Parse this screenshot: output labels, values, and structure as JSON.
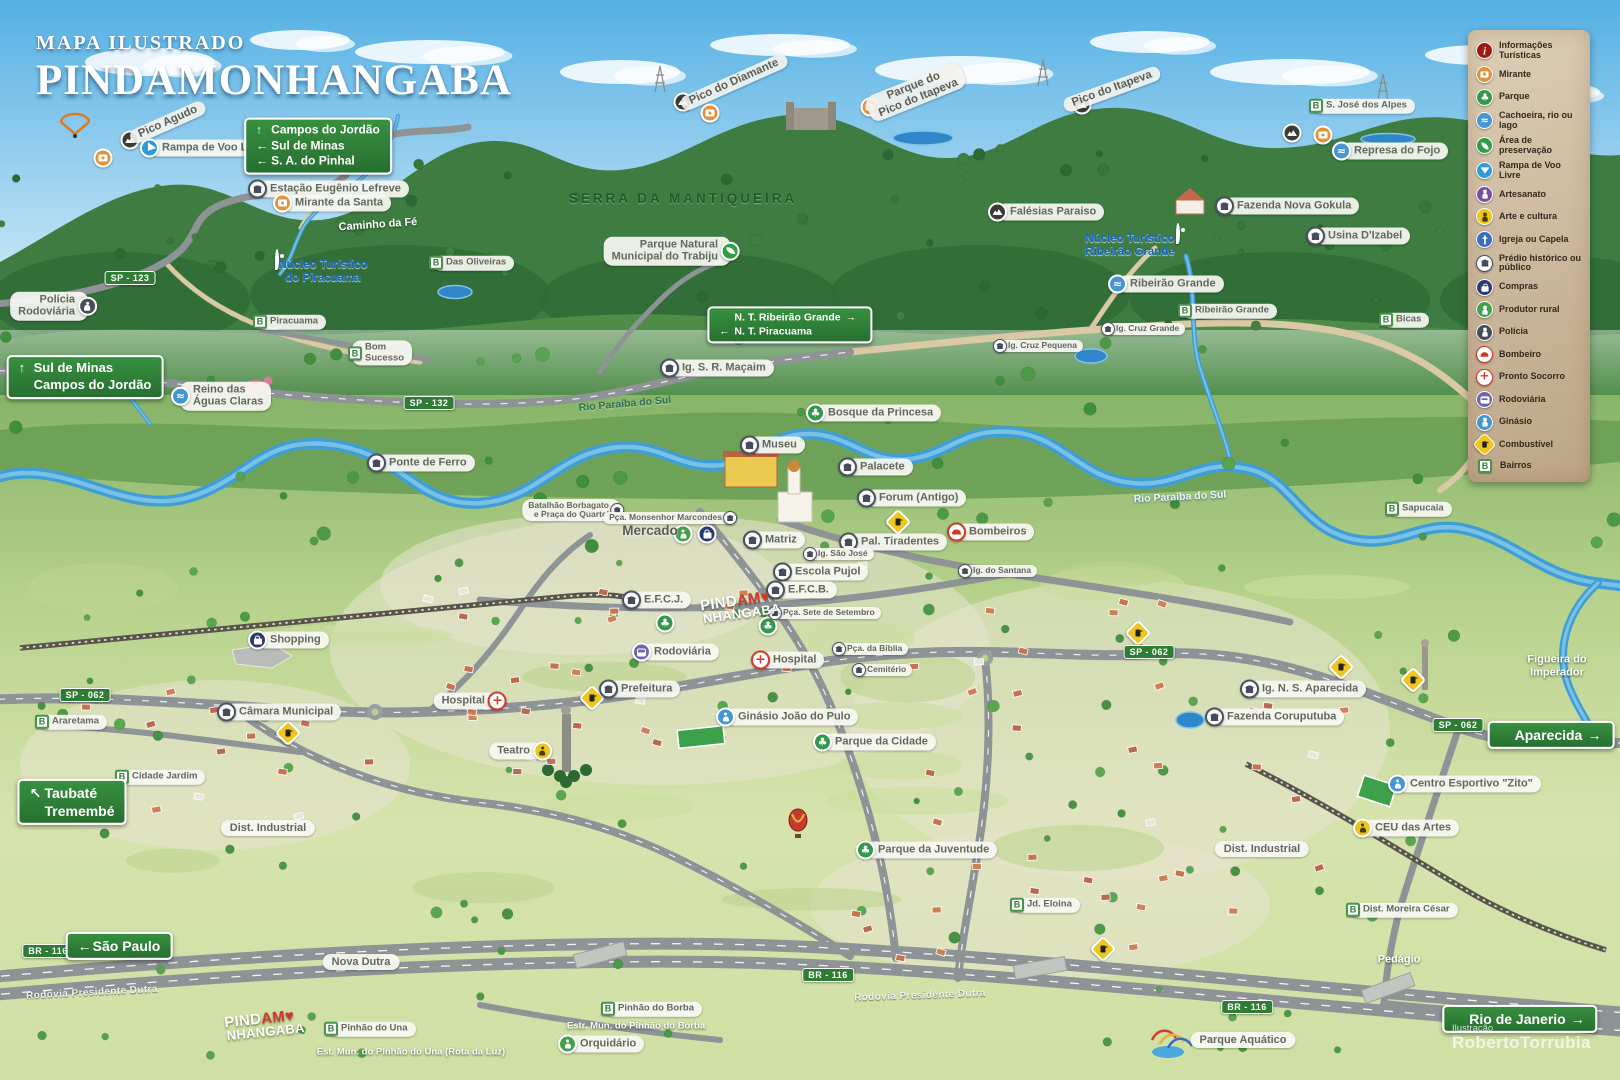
{
  "title": {
    "kicker": "MAPA ILUSTRADO",
    "name": "PINDAMONHANGABA"
  },
  "credit": {
    "label": "Ilustração",
    "name": "RobertoTorrubia"
  },
  "colors": {
    "sign_green": "#2f7d35",
    "pill_bg": "#f7f7f2",
    "water": "#3f9ed6",
    "legend_bg": "#cab69b",
    "logo_red": "#d5352c",
    "pin_blue": "#1565c0"
  },
  "legend": {
    "items": [
      {
        "type": "info",
        "label": "Informações Turísticas"
      },
      {
        "type": "mirante",
        "label": "Mirante"
      },
      {
        "type": "parque",
        "label": "Parque"
      },
      {
        "type": "cachoeira",
        "label": "Cachoeira, rio ou lago"
      },
      {
        "type": "preservacao",
        "label": "Área de preservação"
      },
      {
        "type": "rampa",
        "label": "Rampa de Voo Livre"
      },
      {
        "type": "artesanato",
        "label": "Artesanato"
      },
      {
        "type": "arte",
        "label": "Arte e cultura"
      },
      {
        "type": "igreja",
        "label": "Igreja ou Capela"
      },
      {
        "type": "predio",
        "label": "Prédio histórico ou público"
      },
      {
        "type": "compras",
        "label": "Compras"
      },
      {
        "type": "produtor",
        "label": "Produtor rural"
      },
      {
        "type": "policia",
        "label": "Polícia"
      },
      {
        "type": "bombeiro",
        "label": "Bombeiro"
      },
      {
        "type": "pronto",
        "label": "Pronto Socorro"
      },
      {
        "type": "rodoviaria",
        "label": "Rodoviária"
      },
      {
        "type": "ginasio",
        "label": "Ginásio"
      },
      {
        "type": "combustivel",
        "label": "Combustível"
      },
      {
        "type": "bairro",
        "label": "Bairros"
      }
    ]
  },
  "signs": [
    {
      "name": "sign-campos-do-jordao",
      "x": 318,
      "y": 146,
      "fs": 12,
      "rows": [
        [
          "↑",
          "Campos do Jordão",
          ""
        ],
        [
          "←",
          "Sul de Minas",
          ""
        ],
        [
          "←",
          "S. A. do Pinhal",
          ""
        ]
      ]
    },
    {
      "name": "sign-sul-de-minas",
      "x": 85,
      "y": 377,
      "fs": 13,
      "rows": [
        [
          "↑",
          "Sul de Minas",
          ""
        ],
        [
          "",
          "Campos do Jordão",
          ""
        ]
      ]
    },
    {
      "name": "sign-nucleos-turisticos",
      "x": 790,
      "y": 325,
      "fs": 10.5,
      "rows": [
        [
          "",
          "N. T. Ribeirão Grande",
          "→"
        ],
        [
          "←",
          "N. T. Piracuama",
          ""
        ]
      ]
    },
    {
      "name": "sign-taubate",
      "x": 72,
      "y": 802,
      "fs": 14,
      "rows": [
        [
          "↖",
          "Taubaté",
          ""
        ],
        [
          "",
          "Tremembé",
          ""
        ]
      ]
    },
    {
      "name": "sign-sao-paulo",
      "x": 119,
      "y": 946,
      "fs": 14,
      "rows": [
        [
          "←",
          "São Paulo",
          ""
        ]
      ]
    },
    {
      "name": "sign-aparecida",
      "x": 1551,
      "y": 735,
      "fs": 14,
      "rows": [
        [
          "",
          "Aparecida",
          "→"
        ]
      ]
    },
    {
      "name": "sign-rio-de-janeiro",
      "x": 1520,
      "y": 1019,
      "fs": 14,
      "rows": [
        [
          "",
          "Rio de Janerio",
          "→"
        ]
      ]
    }
  ],
  "road_badges": [
    {
      "text": "SP - 123",
      "x": 130,
      "y": 278
    },
    {
      "text": "SP - 132",
      "x": 429,
      "y": 403
    },
    {
      "text": "SP - 062",
      "x": 85,
      "y": 695
    },
    {
      "text": "SP - 062",
      "x": 1149,
      "y": 652
    },
    {
      "text": "SP - 062",
      "x": 1458,
      "y": 725
    },
    {
      "text": "BR - 116",
      "x": 48,
      "y": 951
    },
    {
      "text": "BR - 116",
      "x": 828,
      "y": 975
    },
    {
      "text": "BR - 116",
      "x": 1247,
      "y": 1007
    }
  ],
  "peaks": [
    {
      "text": "Pico Agudo",
      "x": 168,
      "y": 122,
      "rot": -24
    },
    {
      "text": "Pico do Diamante",
      "x": 734,
      "y": 82,
      "rot": -24
    },
    {
      "lines": [
        "Parque do",
        "Pico do Itapeva"
      ],
      "x": 916,
      "y": 92,
      "rot": -22
    },
    {
      "text": "Pico do Itapeva",
      "x": 1112,
      "y": 89,
      "rot": -20
    }
  ],
  "pois": [
    {
      "icon": "predio",
      "text": "Estação Eugênio Lefreve",
      "x": 258,
      "y": 189
    },
    {
      "icon": "mirante",
      "text": "Mirante da Santa",
      "x": 283,
      "y": 203
    },
    {
      "icon": "rampa",
      "text": "Rampa de Voo Livre",
      "x": 150,
      "y": 148
    },
    {
      "icon": "cachoeira",
      "lines": [
        "Reino das",
        "Águas Claras"
      ],
      "x": 181,
      "y": 396
    },
    {
      "icon": "policia",
      "lines": [
        "Polícia",
        "Rodoviária"
      ],
      "x": 87,
      "y": 306,
      "side": "r"
    },
    {
      "icon": "predio",
      "text": "Ponte de Ferro",
      "x": 377,
      "y": 463
    },
    {
      "icon": "preservacao",
      "lines": [
        "Parque Natural",
        "Municipal  do Trabiju"
      ],
      "x": 730,
      "y": 251,
      "side": "r"
    },
    {
      "icon": "predio",
      "text": "Ig. S. R. Maçaim",
      "x": 670,
      "y": 368
    },
    {
      "icon": "mirante-dark",
      "text": "Falésias Paraiso",
      "x": 998,
      "y": 212
    },
    {
      "icon": "cachoeira",
      "text": "Represa do Fojo",
      "x": 1342,
      "y": 151
    },
    {
      "icon": "predio",
      "text": "Fazenda Nova Gokula",
      "x": 1225,
      "y": 206
    },
    {
      "icon": "predio",
      "text": "Usina D'Izabel",
      "x": 1316,
      "y": 236
    },
    {
      "icon": "cachoeira",
      "text": "Ribeirão Grande",
      "x": 1118,
      "y": 284
    },
    {
      "icon": "predio",
      "text": "Ig. Cruz Grande",
      "x": 1111,
      "y": 329,
      "small": true
    },
    {
      "icon": "predio",
      "text": "Ig. Cruz Pequena",
      "x": 1003,
      "y": 346,
      "small": true
    },
    {
      "icon": "parque",
      "text": "Bosque da Princesa",
      "x": 816,
      "y": 413
    },
    {
      "icon": "predio",
      "text": "Museu",
      "x": 750,
      "y": 445
    },
    {
      "icon": "predio",
      "text": "Palacete",
      "x": 848,
      "y": 467
    },
    {
      "icon": "predio",
      "text": "Forum (Antigo)",
      "x": 867,
      "y": 498
    },
    {
      "icon": "predio",
      "lines": [
        "Batalhão Borbagato",
        "e Praça do Quartel"
      ],
      "x": 614,
      "y": 510,
      "side": "r",
      "small": true
    },
    {
      "icon": "predio",
      "text": "Pça. Monsenhor Marcondes",
      "x": 727,
      "y": 518,
      "side": "r",
      "small": true
    },
    {
      "icon": "predio",
      "text": "Matriz",
      "x": 753,
      "y": 540
    },
    {
      "icon": "predio",
      "text": "Pal. Tiradentes",
      "x": 849,
      "y": 542
    },
    {
      "icon": "predio",
      "text": "Ig. São José",
      "x": 813,
      "y": 554,
      "small": true
    },
    {
      "icon": "bombeiro",
      "text": "Bombeiros",
      "x": 957,
      "y": 532
    },
    {
      "icon": "predio",
      "text": "Ig. do Santana",
      "x": 968,
      "y": 571,
      "small": true
    },
    {
      "icon": "predio",
      "text": "Escola Pujol",
      "x": 783,
      "y": 572
    },
    {
      "icon": "predio",
      "text": "E.F.C.B.",
      "x": 776,
      "y": 590
    },
    {
      "icon": "predio",
      "text": "E.F.C.J.",
      "x": 632,
      "y": 600
    },
    {
      "icon": "predio",
      "text": "Pça. Sete de Setembro",
      "x": 778,
      "y": 613,
      "small": true
    },
    {
      "icon": "rodoviaria",
      "text": "Rodoviária",
      "x": 642,
      "y": 652
    },
    {
      "icon": "pronto",
      "text": "Hospital",
      "x": 761,
      "y": 660
    },
    {
      "icon": "predio",
      "text": "Pça. da Bíblia",
      "x": 842,
      "y": 649,
      "small": true
    },
    {
      "icon": "predio",
      "text": "Cemitério",
      "x": 862,
      "y": 670,
      "small": true
    },
    {
      "icon": "predio",
      "text": "Prefeitura",
      "x": 609,
      "y": 689
    },
    {
      "icon": "pronto",
      "text": "Hospital",
      "x": 497,
      "y": 701,
      "side": "r"
    },
    {
      "icon": "ginasio",
      "text": "Ginásio João do Pulo",
      "x": 726,
      "y": 717
    },
    {
      "icon": "arte",
      "text": "Teatro",
      "x": 542,
      "y": 751,
      "side": "r"
    },
    {
      "icon": "compras",
      "text": "Shopping",
      "x": 258,
      "y": 640
    },
    {
      "icon": "predio",
      "text": "Câmara Municipal",
      "x": 227,
      "y": 712
    },
    {
      "icon": "parque",
      "text": "Parque da Cidade",
      "x": 823,
      "y": 742
    },
    {
      "icon": "parque",
      "text": "Parque da Juventude",
      "x": 866,
      "y": 850
    },
    {
      "icon": "predio",
      "text": "Ig. N. S. Aparecida",
      "x": 1250,
      "y": 689
    },
    {
      "icon": "predio",
      "text": "Fazenda Coruputuba",
      "x": 1215,
      "y": 717
    },
    {
      "icon": "ginasio",
      "text": "Centro Esportivo \"Zito\"",
      "x": 1398,
      "y": 784
    },
    {
      "icon": "arte",
      "text": "CEU das Artes",
      "x": 1363,
      "y": 828
    },
    {
      "icon": "produtor",
      "text": "Orquidário",
      "x": 568,
      "y": 1044
    }
  ],
  "bairros": [
    {
      "text": "S. José dos Alpes",
      "x": 1317,
      "y": 106
    },
    {
      "text": "Das Oliveiras",
      "x": 437,
      "y": 263
    },
    {
      "text": "Piracuama",
      "x": 261,
      "y": 322
    },
    {
      "lines": [
        "Bom",
        "Sucesso"
      ],
      "x": 356,
      "y": 353
    },
    {
      "text": "Ribeirão Grande",
      "x": 1186,
      "y": 311
    },
    {
      "text": "Bicas",
      "x": 1387,
      "y": 320
    },
    {
      "text": "Sapucaia",
      "x": 1393,
      "y": 509
    },
    {
      "text": "Araretama",
      "x": 43,
      "y": 722
    },
    {
      "text": "Cidade Jardim",
      "x": 123,
      "y": 777
    },
    {
      "text": "Jd. Eloina",
      "x": 1018,
      "y": 905
    },
    {
      "text": "Dist. Moreira César",
      "x": 1354,
      "y": 910
    },
    {
      "text": "Pinhão do Una",
      "x": 332,
      "y": 1029
    },
    {
      "text": "Pinhão do Borba",
      "x": 609,
      "y": 1009
    }
  ],
  "plain_pills": [
    {
      "text": "Nova Dutra",
      "x": 361,
      "y": 962
    },
    {
      "text": "Dist. Industrial",
      "x": 268,
      "y": 828
    },
    {
      "text": "Dist. Industrial",
      "x": 1262,
      "y": 849
    },
    {
      "text": "Parque Aquático",
      "x": 1243,
      "y": 1040
    }
  ],
  "blue_pois": [
    {
      "lines": [
        "Núcleo Turístico",
        "do Piracuama"
      ],
      "x": 323,
      "y": 272
    },
    {
      "lines": [
        "Núcleo Turístico",
        "Ribeirão Grande"
      ],
      "x": 1130,
      "y": 246
    }
  ],
  "texts": [
    {
      "text": "SERRA DA MANTIQUEIRA",
      "x": 683,
      "y": 199,
      "cls": "tserra"
    },
    {
      "text": "Caminho da Fé",
      "x": 378,
      "y": 225,
      "cls": "tw",
      "rot": -4
    },
    {
      "text": "Mercado",
      "x": 650,
      "y": 531,
      "cls": "tmerc"
    },
    {
      "text": "Rio Paraíba do Sul",
      "x": 625,
      "y": 404,
      "cls": "trivd",
      "rot": -5
    },
    {
      "text": "Rio Paraíba do Sul",
      "x": 1180,
      "y": 497,
      "cls": "trivl",
      "rot": -3
    },
    {
      "lines": [
        "Figueira do",
        "Imperador"
      ],
      "x": 1557,
      "y": 666,
      "cls": "tw"
    },
    {
      "text": "Pedágio",
      "x": 1399,
      "y": 960,
      "cls": "tw"
    },
    {
      "text": "Rodovia Presidente Dutra",
      "x": 92,
      "y": 993,
      "cls": "troad",
      "rot": -3
    },
    {
      "text": "Rodovia Presidente Dutra",
      "x": 920,
      "y": 996,
      "cls": "troad",
      "rot": -2
    },
    {
      "text": "Est. Mun. do Pinhão do Una (Rota da Luz)",
      "x": 411,
      "y": 1053,
      "cls": "tws"
    },
    {
      "text": "Estr. Mun. do Pinhão do Borba",
      "x": 636,
      "y": 1027,
      "cls": "tws"
    }
  ],
  "icons": [
    {
      "type": "mirante-dark",
      "x": 130,
      "y": 140
    },
    {
      "type": "mirante",
      "x": 103,
      "y": 158
    },
    {
      "type": "mirante-dark",
      "x": 683,
      "y": 102
    },
    {
      "type": "mirante",
      "x": 710,
      "y": 113
    },
    {
      "type": "mirante",
      "x": 870,
      "y": 107
    },
    {
      "type": "mirante-dark",
      "x": 1082,
      "y": 105
    },
    {
      "type": "mirante-dark",
      "x": 1292,
      "y": 133
    },
    {
      "type": "mirante",
      "x": 1323,
      "y": 135
    },
    {
      "type": "pin",
      "x": 277,
      "y": 269
    },
    {
      "type": "pin",
      "x": 1178,
      "y": 243
    },
    {
      "type": "produtor",
      "x": 683,
      "y": 534
    },
    {
      "type": "compras",
      "x": 707,
      "y": 534
    },
    {
      "type": "parque",
      "x": 665,
      "y": 623
    },
    {
      "type": "parque",
      "x": 768,
      "y": 626
    },
    {
      "type": "combustivel",
      "x": 592,
      "y": 698
    },
    {
      "type": "combustivel",
      "x": 898,
      "y": 522
    },
    {
      "type": "combustivel",
      "x": 1138,
      "y": 633
    },
    {
      "type": "combustivel",
      "x": 1413,
      "y": 680
    },
    {
      "type": "combustivel",
      "x": 1341,
      "y": 667
    },
    {
      "type": "combustivel",
      "x": 288,
      "y": 733
    },
    {
      "type": "combustivel",
      "x": 1103,
      "y": 949
    }
  ],
  "logo": {
    "line1_white": "PIND",
    "line1_red": "AM",
    "line1_heart": "♥",
    "line2": "NHANGABA",
    "positions": [
      {
        "x": 736,
        "y": 608,
        "rot": -8
      },
      {
        "x": 260,
        "y": 1026,
        "rot": -6
      }
    ]
  }
}
